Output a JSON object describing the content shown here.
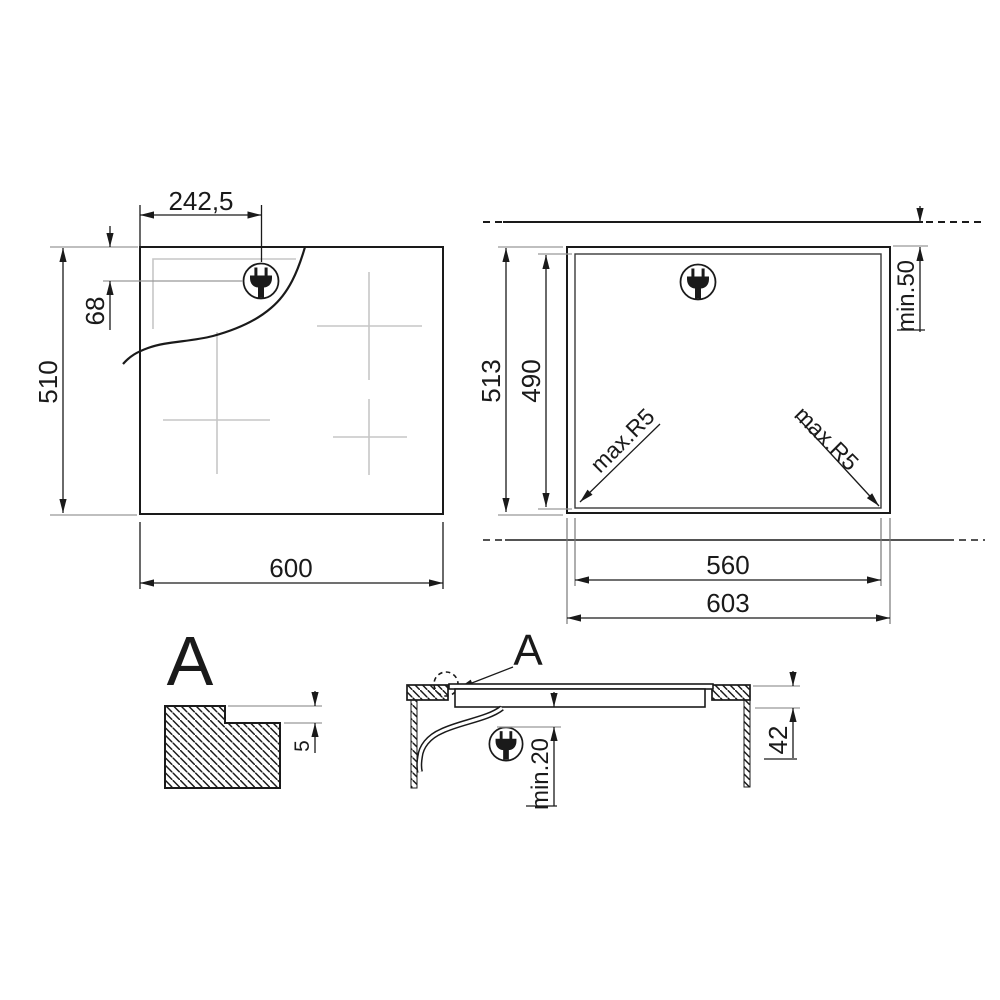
{
  "drawing": {
    "type": "hob-installation-diagram",
    "colors": {
      "ink": "#1a1a1a",
      "extension_lines": "#999999",
      "light_marks": "#c6c6c6",
      "background": "#ffffff"
    }
  },
  "plan_view": {
    "width": "600",
    "height": "510",
    "plug_offset_x": "242,5",
    "plug_offset_y": "68",
    "plug_icon": "power-plug"
  },
  "cutout_view": {
    "outer_width": "603",
    "cutout_width": "560",
    "outer_height": "513",
    "cutout_height": "490",
    "wall_clearance": "min.50",
    "corner_radius_left": "max.R5",
    "corner_radius_right": "max.R5",
    "plug_icon": "power-plug"
  },
  "detail_view": {
    "label": "A",
    "step_height": "5"
  },
  "section_view": {
    "label": "A",
    "total_depth": "42",
    "bottom_clearance": "min.20",
    "plug_icon": "power-plug"
  }
}
